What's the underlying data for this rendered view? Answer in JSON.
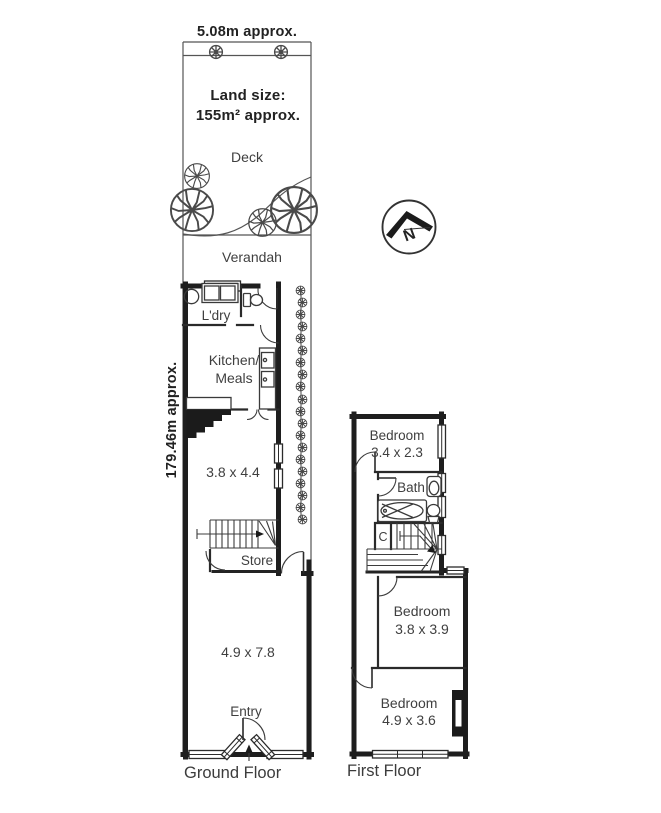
{
  "site": {
    "frontage": "5.08m approx.",
    "depth": "179.46m approx.",
    "land_size_label": "Land size:",
    "land_size_value": "155m² approx."
  },
  "ground_floor": {
    "title": "Ground Floor",
    "deck": "Deck",
    "verandah": "Verandah",
    "laundry": "L'dry",
    "kitchen_line1": "Kitchen/",
    "kitchen_line2": "Meals",
    "living_dims": "3.8 x 4.4",
    "store": "Store",
    "lounge_dims": "4.9 x 7.8",
    "entry": "Entry"
  },
  "first_floor": {
    "title": "First Floor",
    "bedroom1_name": "Bedroom",
    "bedroom1_dims": "3.4 x 2.3",
    "bath": "Bath",
    "cupboard": "C",
    "bedroom2_name": "Bedroom",
    "bedroom2_dims": "3.8 x 3.9",
    "bedroom3_name": "Bedroom",
    "bedroom3_dims": "4.9 x 3.6"
  },
  "compass": {
    "north": "N"
  }
}
